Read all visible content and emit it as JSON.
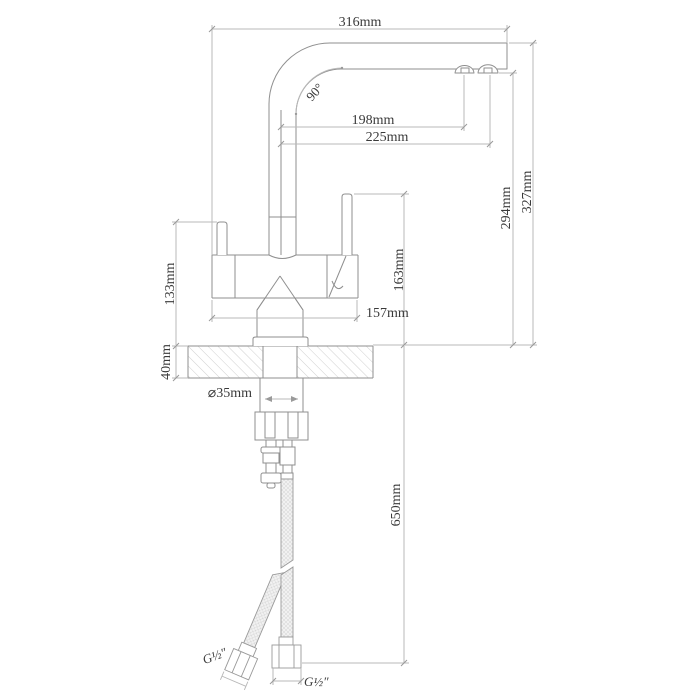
{
  "drawing": {
    "kind": "technical-dimension-drawing",
    "colors": {
      "outline": "#8f8f8f",
      "dimension": "#b8b8b8",
      "tick": "#9a9a9a",
      "text": "#3a3a3a",
      "hatch": "#cfcfcf",
      "hose_fill": "#f1f1f1",
      "background": "#ffffff"
    },
    "dimensions": {
      "spout_reach": "316mm",
      "spout_angle": "90°",
      "outlet1_offset": "198mm",
      "outlet2_offset": "225mm",
      "outlet_height": "294mm",
      "overall_height": "327mm",
      "handle_height": "163mm",
      "body_width": "157mm",
      "body_height": "133mm",
      "counter_thickness": "40mm",
      "hole_diameter": "⌀35mm",
      "hose_length": "650mm",
      "thread_left": "G½″",
      "thread_right": "G½″"
    }
  }
}
